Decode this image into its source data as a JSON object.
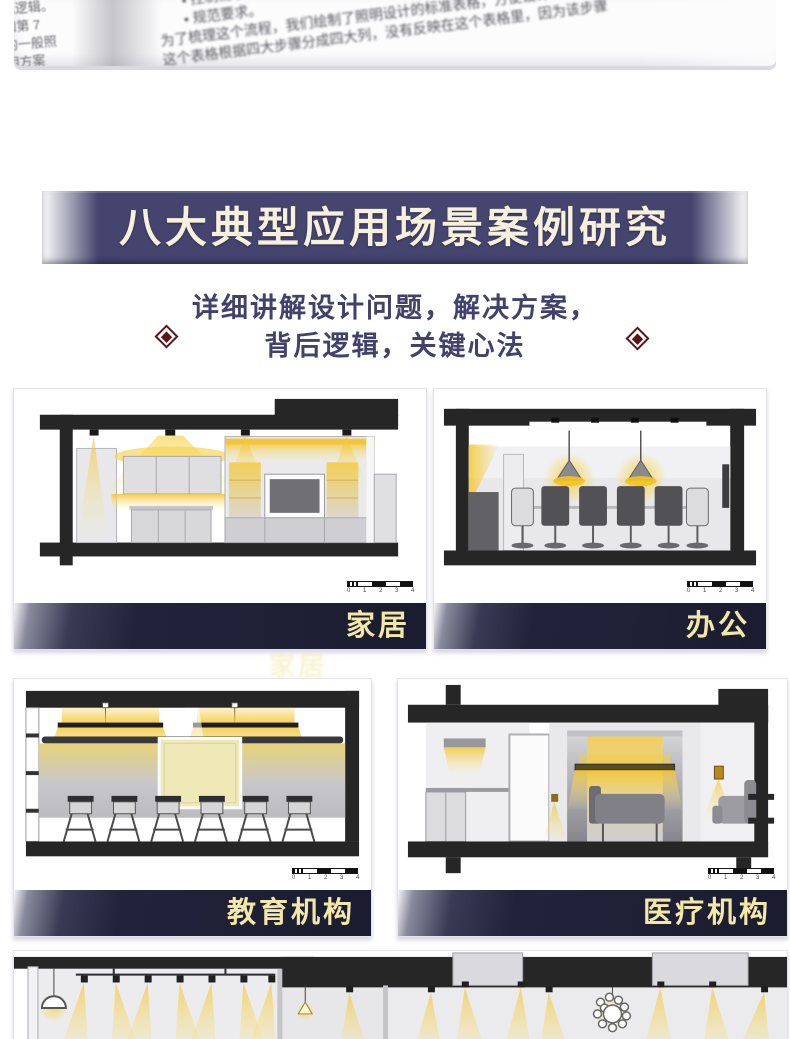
{
  "colors": {
    "banner_bg": "#44446e",
    "banner_text": "#f7f1dc",
    "subtitle_text": "#41416b",
    "diamond_red": "#5c1414",
    "label_bar_bg": "#1c1c30",
    "label_text": "#f2e9a8",
    "light_yellow": "#f3c52e",
    "slab_black": "#262626"
  },
  "book_photo": {
    "left_fragments": [
      "现逻辑。",
      "如第 7",
      "的一般照",
      "明方案"
    ],
    "bullet1": "• 控制需求。",
    "bullet2": "• 规范要求。",
    "line1": "为了梳理这个流程，我们绘制了照明设计的标准表格，方便设计师使用",
    "line2": "这个表格根据四大步骤分成四大列，没有反映在这个表格里，因为该步骤"
  },
  "banner": {
    "title": "八大典型应用场景案例研究"
  },
  "subtitle": {
    "line1": "详细讲解设计问题，解决方案，",
    "line2": "背后逻辑，关键心法"
  },
  "cards": [
    {
      "label": "家居"
    },
    {
      "label": "办公"
    },
    {
      "label": "教育机构"
    },
    {
      "label": "医疗机构"
    },
    {
      "label": ""
    }
  ],
  "scale_bar": {
    "numbers": "0 1 2 3 4 5"
  },
  "ghost_label": "家居"
}
